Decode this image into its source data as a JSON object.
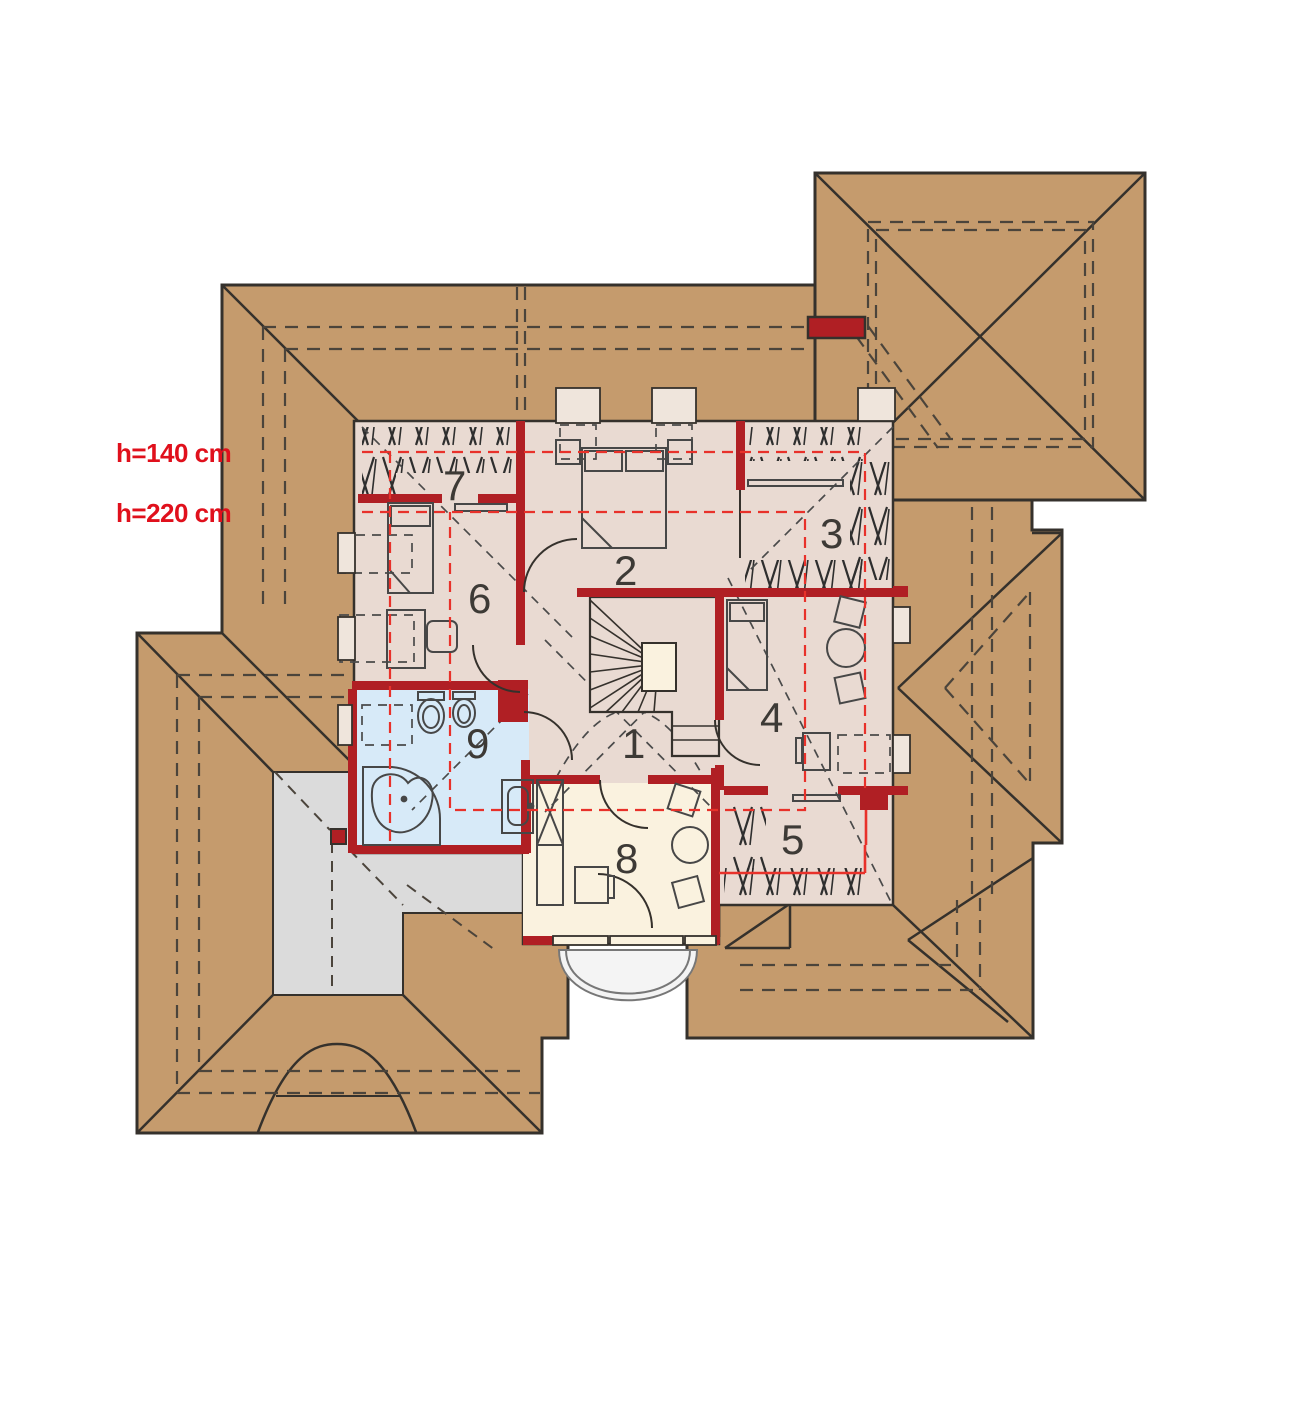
{
  "plan": {
    "type": "attic-floor-plan",
    "height_labels": [
      {
        "id": "h140",
        "text": "h=140 cm",
        "x": 116,
        "y": 462
      },
      {
        "id": "h220",
        "text": "h=220 cm",
        "x": 116,
        "y": 522
      }
    ],
    "rooms": [
      {
        "number": "1",
        "x": 622,
        "y": 758
      },
      {
        "number": "2",
        "x": 614,
        "y": 585
      },
      {
        "number": "3",
        "x": 820,
        "y": 548
      },
      {
        "number": "4",
        "x": 760,
        "y": 732
      },
      {
        "number": "5",
        "x": 781,
        "y": 854
      },
      {
        "number": "6",
        "x": 468,
        "y": 613
      },
      {
        "number": "7",
        "x": 443,
        "y": 500
      },
      {
        "number": "8",
        "x": 615,
        "y": 873
      },
      {
        "number": "9",
        "x": 466,
        "y": 758
      }
    ],
    "colors": {
      "roof": "#C59B6D",
      "roof_line": "#35312c",
      "floor": "#E9DAD2",
      "room8_floor": "#FAF2DF",
      "bathroom_floor": "#D7EAF8",
      "terrace": "#DBDBDB",
      "balcony": "#F4F4F4",
      "wall_red": "#B01F24",
      "red_dashed": "#E8312A",
      "label_red": "#E0101C"
    }
  }
}
